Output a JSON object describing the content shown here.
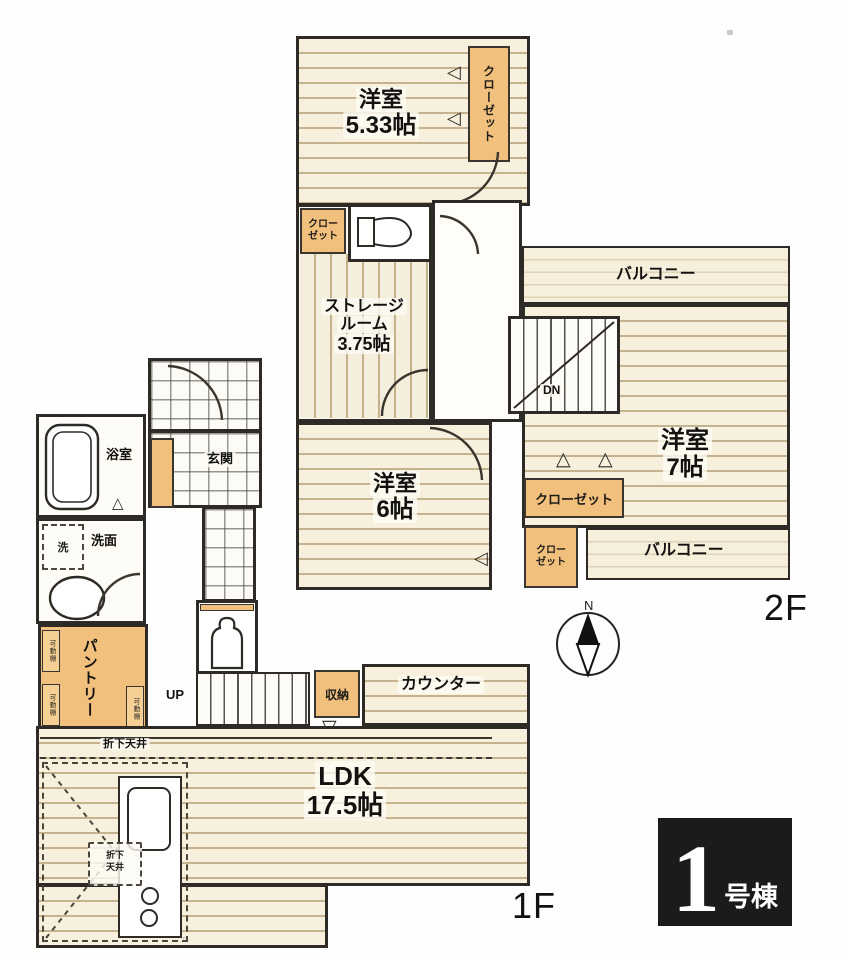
{
  "compass": {
    "north": "N"
  },
  "badge": {
    "number": "1",
    "suffix": "号棟"
  },
  "floor2": {
    "floor_label": "2F",
    "room_533": {
      "name": "洋室",
      "size": "5.33帖"
    },
    "closet_vertical": "クローゼット",
    "closet_nw": {
      "line1": "クロー",
      "line2": "ゼット"
    },
    "storage_room": {
      "line1": "ストレージ",
      "line2": "ルーム",
      "line3": "3.75帖"
    },
    "room_6": {
      "name": "洋室",
      "size": "6帖"
    },
    "room_7": {
      "name": "洋室",
      "size": "7帖"
    },
    "balcony_north": "バルコニー",
    "balcony_south": "バルコニー",
    "closet_east": "クローゼット",
    "closet_south": {
      "line1": "クロー",
      "line2": "ゼット"
    },
    "stairs_label": "DN"
  },
  "floor1": {
    "floor_label": "1F",
    "bath": "浴室",
    "laundry": "洗",
    "washroom": "洗面",
    "entrance": "玄関",
    "pantry": "パントリー",
    "shelf_label": "可動棚",
    "stairs_label": "UP",
    "storage": "収納",
    "counter": "カウンター",
    "ldk_name": "LDK",
    "ldk_size": "17.5帖",
    "ceiling_note": "折下天井",
    "kitchen_note": {
      "line1": "折下",
      "line2": "天井"
    }
  }
}
